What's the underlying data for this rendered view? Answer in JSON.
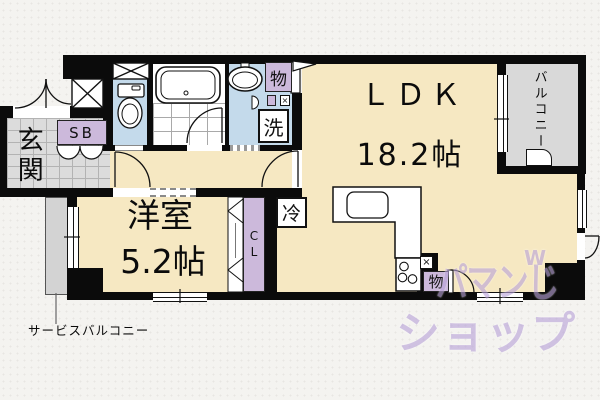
{
  "rooms": {
    "ldk": {
      "label": "ＬＤＫ",
      "size": "18.2帖"
    },
    "western": {
      "label": "洋室",
      "size": "5.2帖"
    },
    "entrance": {
      "label": "玄関"
    },
    "balcony": {
      "label": "バルコニー"
    },
    "service_balcony": {
      "label": "サービスバルコニー"
    }
  },
  "fixtures": {
    "shoe_box": "SB",
    "closet": "CL",
    "fridge": "冷",
    "washer": "洗",
    "storage_top": "物",
    "storage_bottom": "物",
    "cross": "×"
  },
  "watermark": {
    "line1": "パマンじ",
    "mark": "W",
    "line2": "ショップ"
  },
  "colors": {
    "floor": "#F6E8C2",
    "wet": "#C4DAEB",
    "tile": "#DCDCDC",
    "balcony": "#D9D9D9",
    "purple": "#CCB9DB",
    "wall": "#0B0B0B",
    "watermark": "#B9A3D9"
  }
}
